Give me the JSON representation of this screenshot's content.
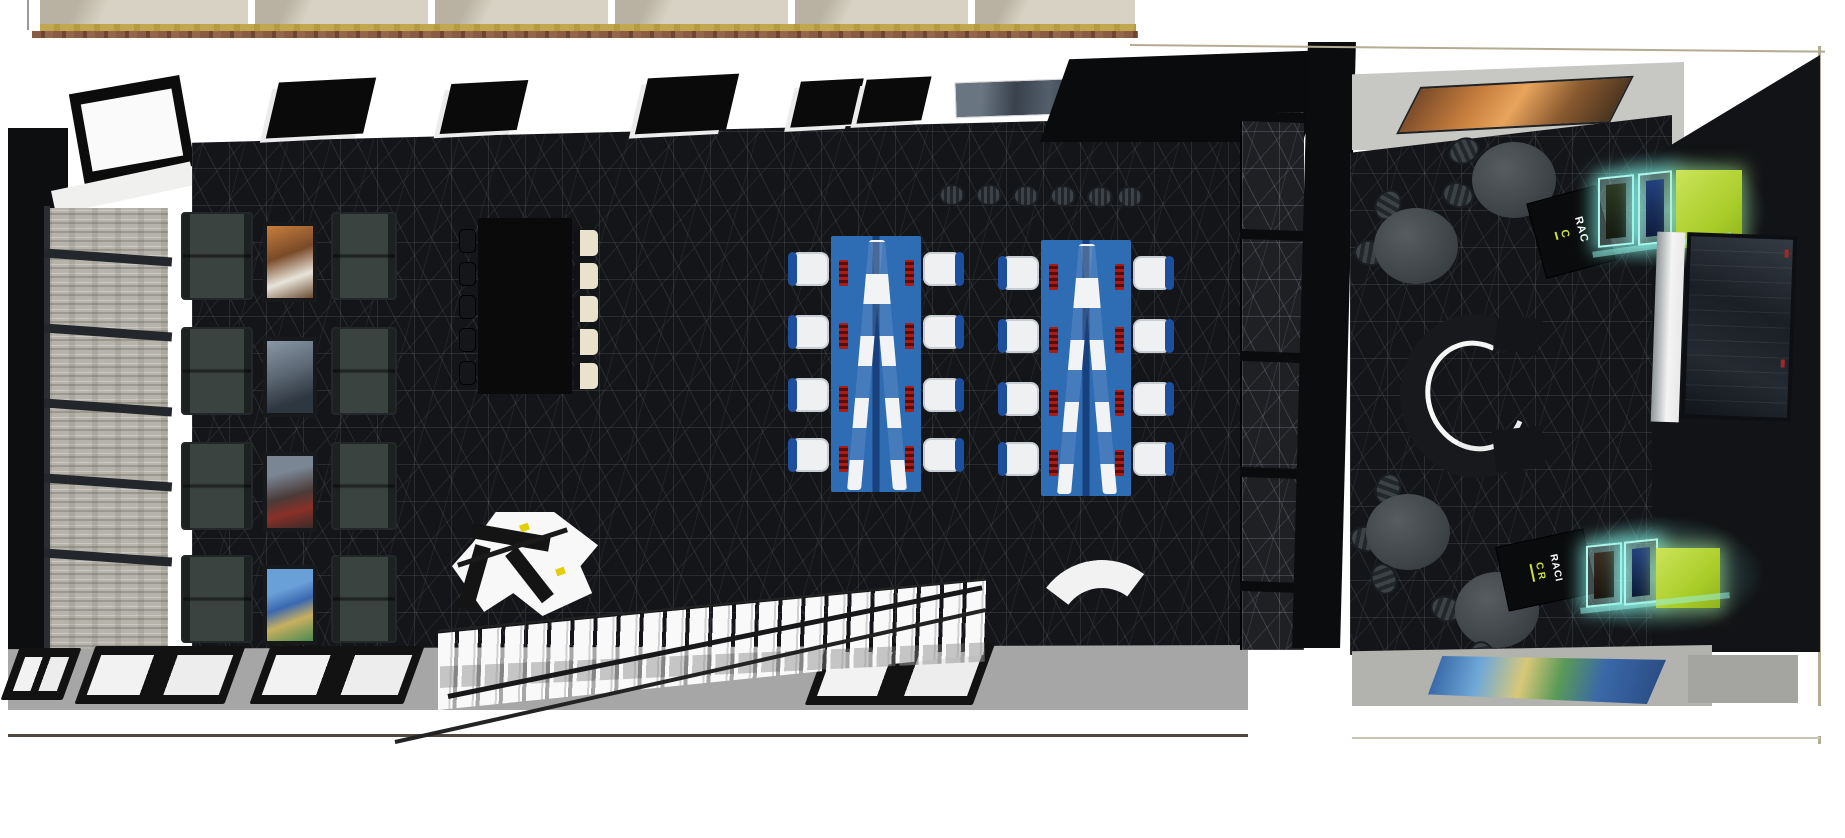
{
  "meta": {
    "title": "Esports gaming lounge — top-down 3D floor plan render",
    "view": "top-down perspective",
    "rooms": [
      "main gaming hall",
      "console lounge"
    ]
  },
  "palette": {
    "page-bg": "#ffffff",
    "marble-base": "#141518",
    "wall-black": "#0d0e10",
    "stone": "#b6b3aa",
    "floor-gray": "#a6a6a6",
    "desk-blue": "#2e6cb3",
    "desk-seam": "#17407c",
    "chair-white": "#eef0f2",
    "chair-blue": "#1d4f9e",
    "kbd-red": "#8a1412",
    "table-black": "#0a0a0a",
    "seat-cream": "#e9e3cd",
    "sofa-dark": "#3a433f",
    "pillar-beige": "#d8d2c4",
    "pillar-shade": "#b9b2a2",
    "gold-strip": "#c2a751",
    "brown-strip": "#8a5c44",
    "lime": "#b5d435",
    "glow": "#8df2e6",
    "wall-gray": "#c7c7c3",
    "led-white": "#f8f8f8",
    "frame-khaki": "#b3ac93"
  },
  "upper_corridor": {
    "pillar_count": 6
  },
  "main_room": {
    "skylights": 5,
    "ceiling_screen": 1,
    "window": 1,
    "lounge_booths": {
      "count": 4,
      "sofas_per_booth": 2,
      "art_tables": 4
    },
    "conference_table": {
      "chairs_dark": 5,
      "chairs_cream": 5
    },
    "gaming_pods": {
      "groups": 2,
      "stations_per_group": 8,
      "chair_style": "white-blue gaming chair",
      "keyboard_color": "red"
    },
    "bar_stools": 6,
    "reception_desk": {
      "shape": "hexagonal",
      "accent_dots": 2
    },
    "staircase": {
      "steps": 23
    },
    "floor_display_cases": 3,
    "glass_partition_panels": 5
  },
  "right_room": {
    "wall_posters": 2,
    "round_tables": 4,
    "curved_reception_desk": 1,
    "wall_tv": 1,
    "game_displays": [
      {
        "white_text": "RAC",
        "accent_text": "C"
      },
      {
        "white_text": "RACI",
        "accent_text": "C R"
      }
    ],
    "console_cubes": 2
  }
}
